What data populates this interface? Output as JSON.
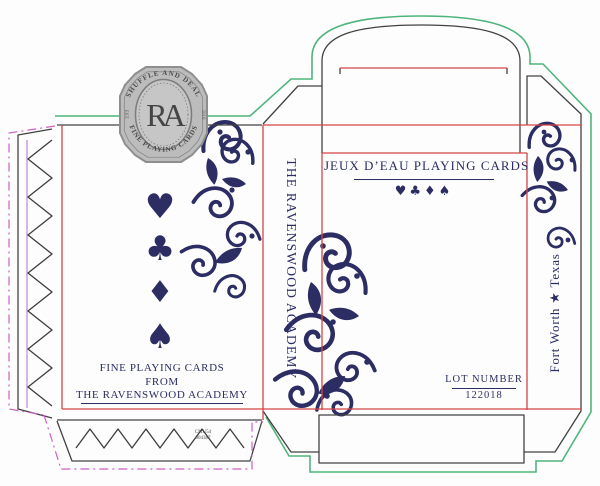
{
  "palette": {
    "navy": "#2b2d63",
    "dieline_red": "#d64545",
    "dieline_green": "#4fb57c",
    "dieline_magenta": "#cf5fc5",
    "dieline_violet": "#b06fd0",
    "dieline_black": "#424242",
    "badge_gray": "#bcbcbc"
  },
  "badge": {
    "top_arc": "SHUFFLE AND DEAL",
    "monogram": "RA",
    "bottom_arc": "FINE PLAYING CARDS",
    "left_side": "EST.",
    "right_side": "2016"
  },
  "back_panel": {
    "suits": [
      "♥",
      "♣",
      "♦",
      "♠"
    ],
    "tagline_line1": "FINE PLAYING CARDS",
    "tagline_line2": "FROM",
    "tagline_line3": "THE RAVENSWOOD ACADEMY"
  },
  "left_spine": {
    "text": "THE RAVENSWOOD ACADEMY"
  },
  "front_panel": {
    "title": "JEUX D’EAU PLAYING CARDS",
    "suits_row": "♥♣♦♠",
    "lot_label": "LOT NUMBER",
    "lot_number": "122018"
  },
  "right_spine": {
    "text": "Fort Worth ★ Texas"
  },
  "glue_flap": {
    "print_code_line1": "CMU54",
    "print_code_line2": "004387"
  }
}
